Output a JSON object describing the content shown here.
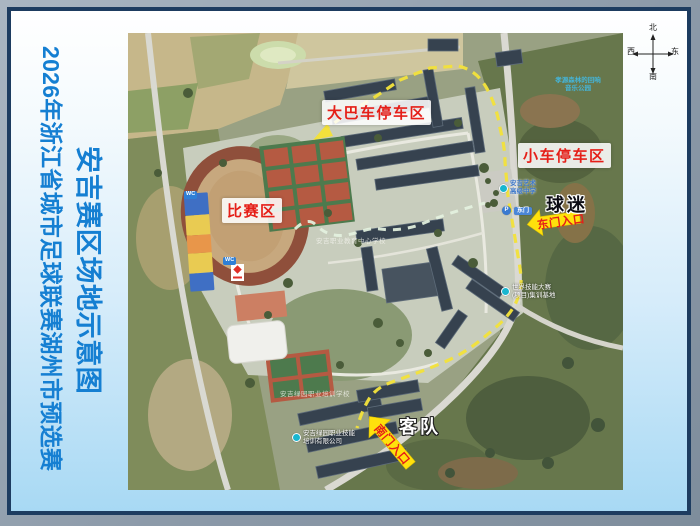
{
  "title": {
    "line1": "2026年浙江省城市足球联赛湖州市预选赛",
    "line2": "安吉赛区场地示意图"
  },
  "compass": {
    "north": "北",
    "south": "南",
    "east": "东",
    "west": "西"
  },
  "map": {
    "zones": {
      "bus_parking": "大巴车停车区",
      "car_parking": "小车停车区",
      "match_area": "比赛区"
    },
    "groups": {
      "fans": "球迷",
      "away_team": "客队"
    },
    "gates": {
      "east": "东门入口",
      "south": "南门入口"
    },
    "pois": {
      "music_park_line1": "孝源森林的回响",
      "music_park_line2": "音乐公园",
      "school_line1": "安吉艺术",
      "school_line2": "高级中学",
      "parking_badge": "P",
      "east_gate_badge": "东门",
      "skills_base_line1": "世界技能大赛",
      "skills_base_line2": "(项目)集训基地",
      "training_co_line1": "安吉绿园职业技能",
      "training_co_line2": "培训有限公司",
      "campus_center": "安吉职业教育中心学校",
      "campus_south": "安吉绿园职业培训学校",
      "wc": "WC"
    }
  },
  "colors": {
    "title_blue": "#157fd2",
    "label_red": "#e51f18",
    "arrow_yellow": "#ffe10c",
    "route_yellow": "#f2e13c",
    "frame_navy": "#1d3c60"
  }
}
